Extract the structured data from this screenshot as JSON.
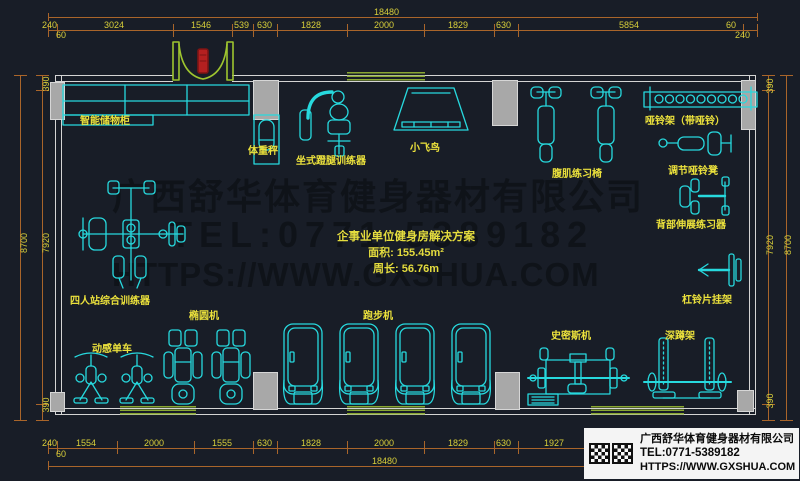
{
  "watermark": {
    "company": "广西舒华体育健身器材有限公司",
    "tel": "TEL:0771-5389182",
    "url": "HTTPS://WWW.GXSHUA.COM"
  },
  "solution": {
    "title": "企事业单位健身房解决方案",
    "area": "面积: 155.45m²",
    "perimeter": "周长: 56.76m"
  },
  "infobox": {
    "company": "广西舒华体育健身器材有限公司",
    "tel": "TEL:0771-5389182",
    "url": "HTTPS://WWW.GXSHUA.COM"
  },
  "equipment": {
    "locker": "智能储物柜",
    "scale": "体重秤",
    "leg_press": "坐式蹬腿训练器",
    "fly": "小飞鸟",
    "ab_bench": "腹肌练习椅",
    "dumbbell_rack": "哑铃架（带哑铃）",
    "adj_bench": "调节哑铃凳",
    "back_ext": "背部伸展练习器",
    "plate_rack": "杠铃片挂架",
    "four_station": "四人站综合训练器",
    "elliptical": "椭圆机",
    "spin_bike": "动感单车",
    "treadmill": "跑步机",
    "smith": "史密斯机",
    "squat": "深蹲架"
  },
  "dims": {
    "top_total": "18480",
    "top": [
      "240",
      "3024",
      "1546",
      "539",
      "630",
      "1828",
      "2000",
      "1829",
      "630",
      "5854",
      "60"
    ],
    "top_left_minor": "60",
    "top_right_minor": "240",
    "bottom": [
      "240",
      "1554",
      "2000",
      "1555",
      "630",
      "1828",
      "2000",
      "1829",
      "630",
      "1927"
    ],
    "bottom_minor": "60",
    "bottom_total": "18480",
    "left": {
      "top": "390",
      "inner": "7920",
      "outer": "8700",
      "bottom": "390"
    },
    "right": {
      "top": "390",
      "inner": "7920",
      "outer": "8700",
      "bottom": "390"
    }
  },
  "colors": {
    "background": "#181d27",
    "equipment": "#27d9de",
    "dimension_line": "#a9652a",
    "dimension_text": "#d8cf3a",
    "label_text": "#ece23c",
    "window_green": "#8aa832",
    "door_green": "#9ec52f",
    "door_red": "#b42020",
    "wall": "#d4d4d4",
    "column": "#a8a8a8",
    "watermark": "#0f1319"
  }
}
